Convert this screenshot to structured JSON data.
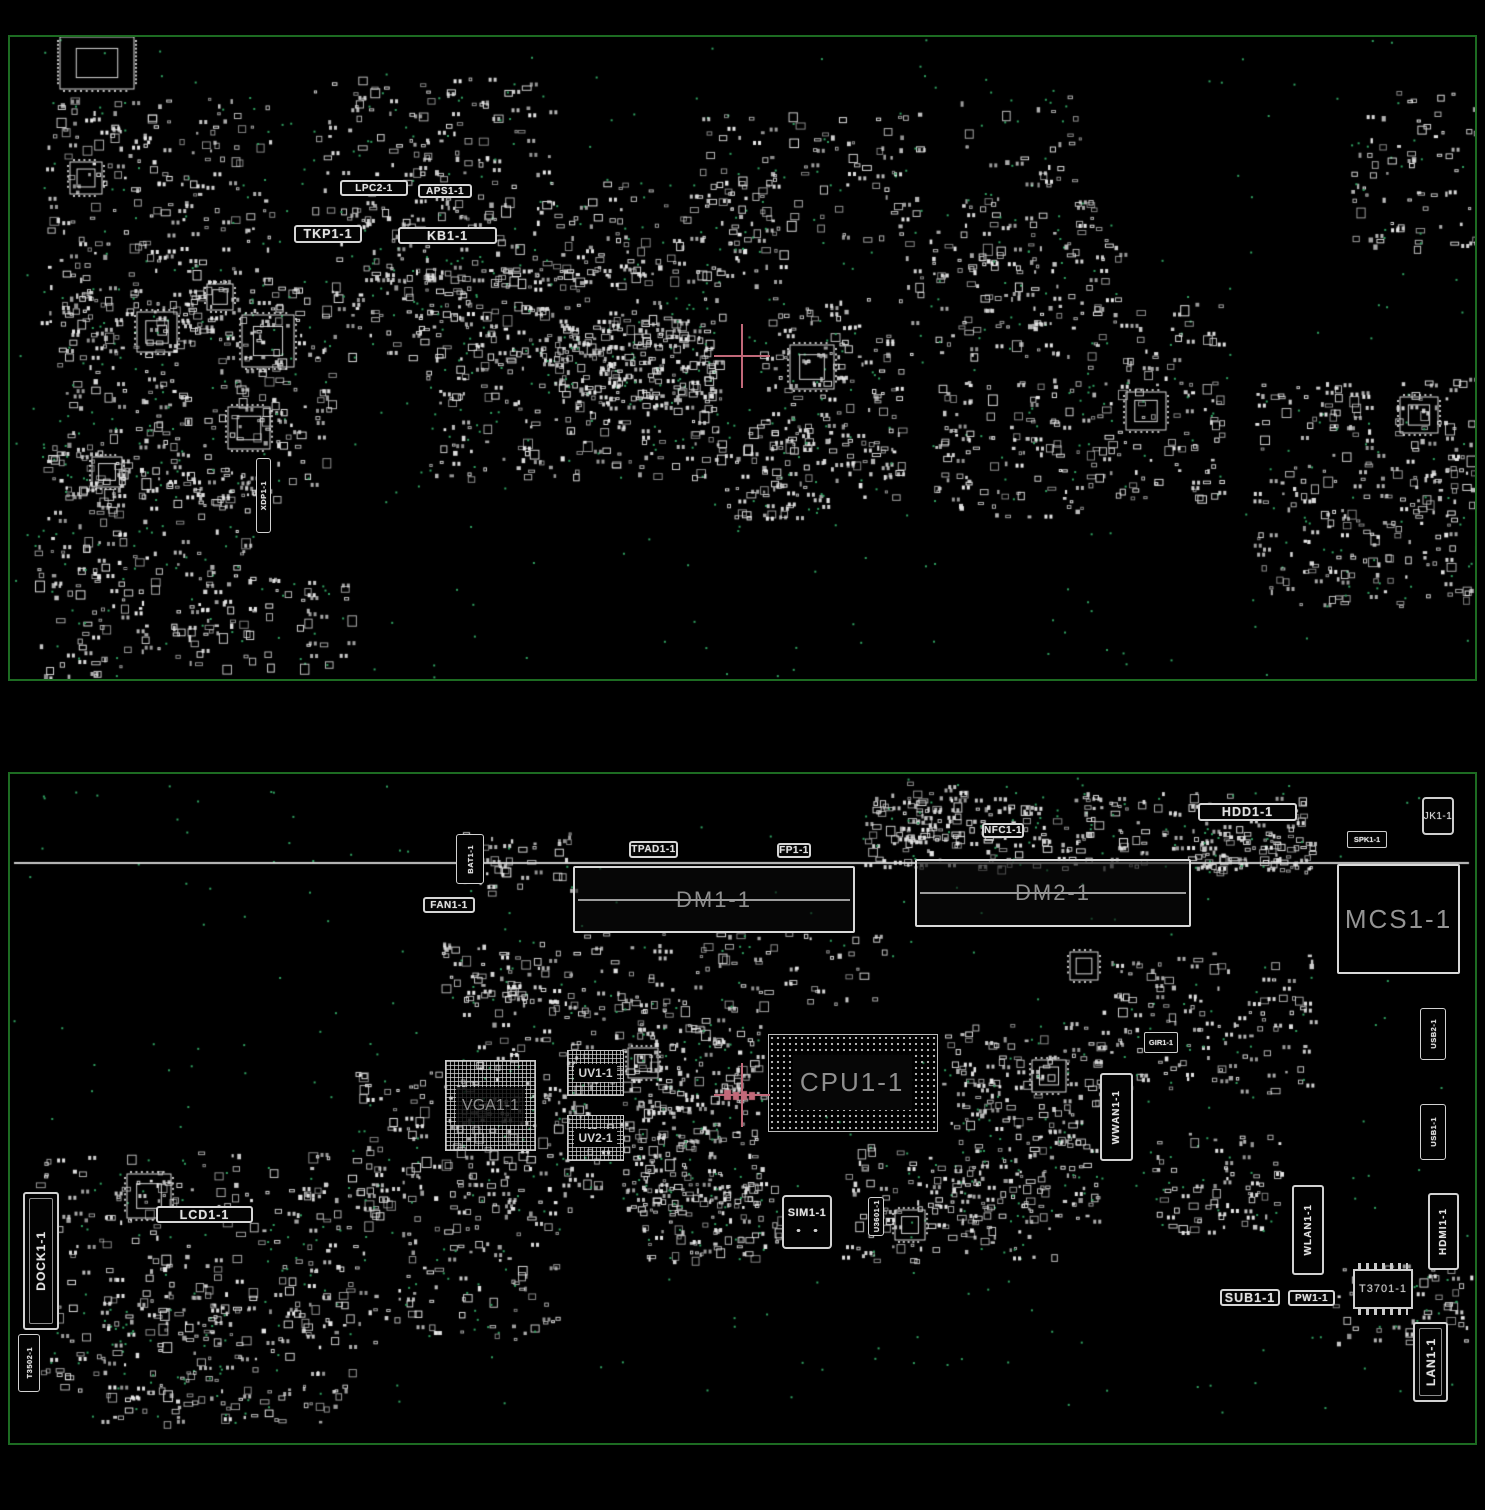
{
  "colors": {
    "background": "#000000",
    "board_outline": "#1d6b22",
    "component_outline": "#d8d8d8",
    "test_point": "#2f9e5f",
    "dim_text": "#8f8f8f",
    "bright_text": "#e4e4e4",
    "crosshair": "#c16979"
  },
  "top_board": {
    "crosshair": {
      "x": 742,
      "y": 356
    },
    "components": [
      {
        "label": "LPC2-1",
        "type": "labelbox",
        "x": 340,
        "y": 180,
        "w": 68,
        "h": 16
      },
      {
        "label": "APS1-1",
        "type": "labelbox",
        "x": 418,
        "y": 184,
        "w": 54,
        "h": 14
      },
      {
        "label": "TKP1-1",
        "type": "labelbox-lg",
        "x": 294,
        "y": 225,
        "w": 68,
        "h": 18
      },
      {
        "label": "KB1-1",
        "type": "labelbox-lg",
        "x": 398,
        "y": 227,
        "w": 99,
        "h": 17
      },
      {
        "label": "XDP1-1",
        "type": "vlabelbox-sm",
        "x": 256,
        "y": 458,
        "w": 15,
        "h": 75
      }
    ]
  },
  "bottom_board": {
    "crosshair": {
      "x": 742,
      "y": 1095
    },
    "components": [
      {
        "label": "BAT1-1",
        "type": "vlabelbox-sm",
        "x": 456,
        "y": 834,
        "w": 28,
        "h": 50
      },
      {
        "label": "FAN1-1",
        "type": "labelbox",
        "x": 423,
        "y": 897,
        "w": 52,
        "h": 16
      },
      {
        "label": "TPAD1-1",
        "type": "labelbox",
        "x": 629,
        "y": 841,
        "w": 49,
        "h": 17
      },
      {
        "label": "FP1-1",
        "type": "labelbox",
        "x": 777,
        "y": 843,
        "w": 34,
        "h": 15
      },
      {
        "label": "NFC1-1",
        "type": "labelbox",
        "x": 982,
        "y": 823,
        "w": 42,
        "h": 15
      },
      {
        "label": "HDD1-1",
        "type": "labelbox-lg",
        "x": 1198,
        "y": 803,
        "w": 99,
        "h": 18
      },
      {
        "label": "SPK1-1",
        "type": "labelbox-sm",
        "x": 1347,
        "y": 831,
        "w": 40,
        "h": 17
      },
      {
        "label": "JK1-1",
        "type": "plainbox",
        "x": 1422,
        "y": 797,
        "w": 32,
        "h": 38
      },
      {
        "label": "DM1-1",
        "type": "slot",
        "x": 573,
        "y": 866,
        "w": 282,
        "h": 67
      },
      {
        "label": "DM2-1",
        "type": "slot",
        "x": 915,
        "y": 859,
        "w": 276,
        "h": 68
      },
      {
        "label": "MCS1-1",
        "type": "bigbox",
        "x": 1337,
        "y": 864,
        "w": 123,
        "h": 110
      },
      {
        "label": "USB2-1",
        "type": "vlabelbox-sm",
        "x": 1420,
        "y": 1008,
        "w": 26,
        "h": 52
      },
      {
        "label": "GIR1-1",
        "type": "labelbox-sm",
        "x": 1144,
        "y": 1032,
        "w": 34,
        "h": 21
      },
      {
        "label": "UV1-1",
        "type": "bga",
        "x": 567,
        "y": 1050,
        "w": 57,
        "h": 46
      },
      {
        "label": "UV2-1",
        "type": "bga",
        "x": 567,
        "y": 1115,
        "w": 57,
        "h": 46
      },
      {
        "label": "VGA1-1",
        "type": "bga-lg",
        "x": 445,
        "y": 1060,
        "w": 91,
        "h": 91
      },
      {
        "label": "CPU1-1",
        "type": "cpu",
        "x": 768,
        "y": 1034,
        "w": 170,
        "h": 98
      },
      {
        "label": "WWAN1-1",
        "type": "vlabelbox",
        "x": 1100,
        "y": 1073,
        "w": 33,
        "h": 88
      },
      {
        "label": "USB1-1",
        "type": "vlabelbox-sm",
        "x": 1420,
        "y": 1104,
        "w": 26,
        "h": 56
      },
      {
        "label": "LCD1-1",
        "type": "labelbox-lg",
        "x": 156,
        "y": 1206,
        "w": 97,
        "h": 17
      },
      {
        "label": "DOCK1-1",
        "type": "vconn",
        "x": 23,
        "y": 1192,
        "w": 36,
        "h": 138
      },
      {
        "label": "SIM1-1",
        "type": "simbox",
        "x": 782,
        "y": 1195,
        "w": 50,
        "h": 54
      },
      {
        "label": "U3601-1",
        "type": "vlabelbox-sm",
        "x": 868,
        "y": 1197,
        "w": 16,
        "h": 39
      },
      {
        "label": "WLAN1-1",
        "type": "vlabelbox",
        "x": 1292,
        "y": 1185,
        "w": 32,
        "h": 90
      },
      {
        "label": "SUB1-1",
        "type": "labelbox-lg",
        "x": 1220,
        "y": 1289,
        "w": 60,
        "h": 17
      },
      {
        "label": "PW1-1",
        "type": "labelbox",
        "x": 1288,
        "y": 1290,
        "w": 47,
        "h": 16
      },
      {
        "label": "T3701-1",
        "type": "icpins",
        "x": 1353,
        "y": 1269,
        "w": 60,
        "h": 40
      },
      {
        "label": "HDMI1-1",
        "type": "vlabelbox",
        "x": 1428,
        "y": 1193,
        "w": 31,
        "h": 77
      },
      {
        "label": "LAN1-1",
        "type": "vconn",
        "x": 1413,
        "y": 1322,
        "w": 35,
        "h": 80
      },
      {
        "label": "T3502-1",
        "type": "vlabelbox-sm",
        "x": 18,
        "y": 1334,
        "w": 22,
        "h": 58
      }
    ]
  }
}
